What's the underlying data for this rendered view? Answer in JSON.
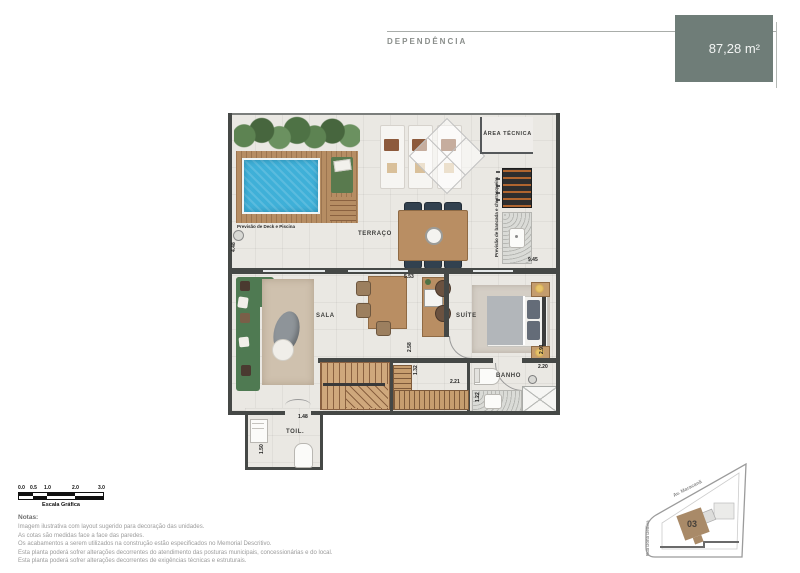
{
  "header": {
    "title": "DEPENDÊNCIA",
    "area": "87,28 m²",
    "accent_color": "#6f7d78"
  },
  "plan": {
    "labels": {
      "terraco": "TERRAÇO",
      "sala": "SALA",
      "suite": "SUÍTE",
      "banho": "BANHO",
      "toil": "TOIL.",
      "area_tecnica": "ÁREA TÉCNICA"
    },
    "captions": {
      "deck": "Previsão de Deck e Piscina",
      "bancada": "Previsão de bancada e churrasqueira"
    },
    "dims": {
      "left_wall": "4.48",
      "sala_door": "5.53",
      "right_top": "9.45",
      "suite_side": "2.91",
      "banho_side": "2.20",
      "hall": "2.58",
      "closet_depth": "1.32",
      "closet_width": "2.21",
      "banho_width": "1.22",
      "toil_width": "1.48",
      "toil_depth": "1.50"
    }
  },
  "scalebar": {
    "ticks": [
      "0.0",
      "0.5",
      "1.0",
      "2.0",
      "3.0"
    ],
    "caption": "Escala Gráfica"
  },
  "notes": {
    "title": "Notas:",
    "lines": [
      "Imagem ilustrativa com layout sugerido para decoração das unidades.",
      "As cotas são medidas face a face das paredes.",
      "Os acabamentos a serem utilizados na construção estão especificados no Memorial Descritivo.",
      "Esta planta poderá sofrer alterações decorrentes do atendimento das posturas municipais, concessionárias e do local.",
      "Esta planta poderá sofrer alterações decorrentes de exigências técnicas e estruturais."
    ]
  },
  "siteplan": {
    "street_top": "Av. Maracanã",
    "street_left": "Rua Dona Delfina",
    "unit": "03"
  }
}
